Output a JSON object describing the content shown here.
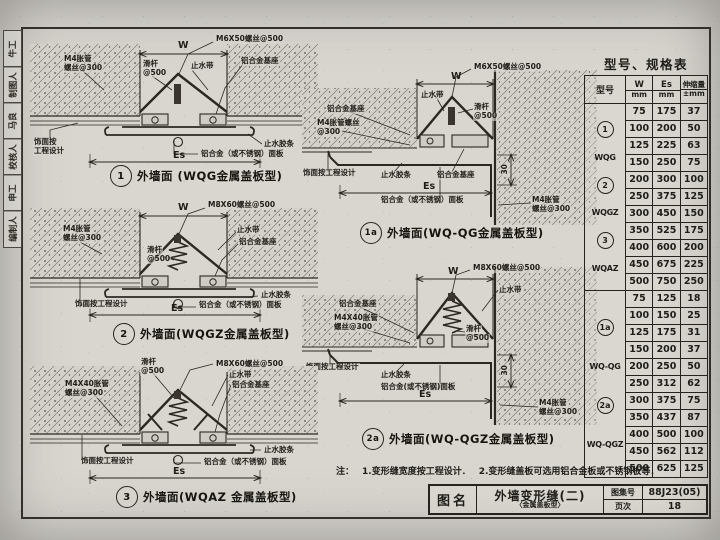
{
  "margin": {
    "cells": [
      "牛工",
      "制图人",
      "马良",
      "校核人",
      "申工",
      "编制人"
    ]
  },
  "table": {
    "title": "型号、规格表",
    "col_model": "型号",
    "col_w": "W",
    "col_es": "Es",
    "col_ext": "伸缩量",
    "unit_mm": "mm",
    "unit_pm": "±mm",
    "group1": {
      "types": [
        {
          "num": "1",
          "name": "WQG"
        },
        {
          "num": "2",
          "name": "WQGZ"
        },
        {
          "num": "3",
          "name": "WQAZ"
        }
      ],
      "rows": [
        [
          "75",
          "175",
          "37"
        ],
        [
          "100",
          "200",
          "50"
        ],
        [
          "125",
          "225",
          "63"
        ],
        [
          "150",
          "250",
          "75"
        ],
        [
          "200",
          "300",
          "100"
        ],
        [
          "250",
          "375",
          "125"
        ],
        [
          "300",
          "450",
          "150"
        ],
        [
          "350",
          "525",
          "175"
        ],
        [
          "400",
          "600",
          "200"
        ],
        [
          "450",
          "675",
          "225"
        ],
        [
          "500",
          "750",
          "250"
        ]
      ]
    },
    "group2": {
      "types": [
        {
          "num": "1a",
          "name": "WQ-QG"
        },
        {
          "num": "2a",
          "name": "WQ-QGZ"
        }
      ],
      "rows": [
        [
          "75",
          "125",
          "18"
        ],
        [
          "100",
          "150",
          "25"
        ],
        [
          "125",
          "175",
          "31"
        ],
        [
          "150",
          "200",
          "37"
        ],
        [
          "200",
          "250",
          "50"
        ],
        [
          "250",
          "312",
          "62"
        ],
        [
          "300",
          "375",
          "75"
        ],
        [
          "350",
          "437",
          "87"
        ],
        [
          "400",
          "500",
          "100"
        ],
        [
          "450",
          "562",
          "112"
        ],
        [
          "500",
          "625",
          "125"
        ]
      ]
    }
  },
  "note": {
    "prefix": "注：",
    "item1": "1.变形缝宽度按工程设计．",
    "item2": "2.变形缝盖板可选用铝合金板或不锈钢板等．"
  },
  "titleblock": {
    "name_label": "图名",
    "title": "外墙变形缝(二)",
    "subtitle": "〈金属盖板型〉",
    "atlas_label": "图集号",
    "atlas_no": "88J23(05)",
    "page_label": "页次",
    "page_no": "18"
  },
  "drawings": {
    "d1": {
      "num": "1",
      "caption": "外墙面 (WQG金属盖板型)",
      "labels": {
        "m4_1": "M4胀管",
        "m4_2": "螺丝@300",
        "rod_1": "滑杆",
        "rod_2": "@500",
        "w": "W",
        "screw": "M6X50螺丝@500",
        "stop": "止水带",
        "base": "铝合金基座",
        "finish_1": "饰面按",
        "finish_2": "工程设计",
        "es": "Es",
        "seal": "止水胶条",
        "plate": "铝合金（或不锈钢）面板"
      }
    },
    "d1a": {
      "num": "1a",
      "caption": "外墙面(WQ-QG金属盖板型)",
      "labels": {
        "screw": "M6X50螺丝@500",
        "w": "W",
        "stop": "止水带",
        "rod_1": "滑杆",
        "rod_2": "@500",
        "base_l": "铝合金基座",
        "m4a_1": "M4胀管螺丝",
        "m4a_2": "@300",
        "finish": "饰面按工程设计",
        "seal": "止水胶条",
        "base_c": "铝合金基座",
        "es": "Es",
        "plate": "铝合金（或不锈钢）面板",
        "dim30": "30",
        "m4b_1": "M4胀管",
        "m4b_2": "螺丝@300"
      }
    },
    "d2": {
      "num": "2",
      "caption": "外墙面(WQGZ金属盖板型)",
      "labels": {
        "m4_1": "M4胀管",
        "m4_2": "螺丝@300",
        "w": "W",
        "screw": "M8X60螺丝@500",
        "stop": "止水带",
        "base": "铝合金基座",
        "rod_1": "滑杆",
        "rod_2": "@500",
        "finish": "饰面按工程设计",
        "es": "Es",
        "seal": "止水胶条",
        "plate": "铝合金（或不锈钢）面板"
      }
    },
    "d2a": {
      "num": "2a",
      "caption": "外墙面(WQ-QGZ金属盖板型)",
      "labels": {
        "screw": "M8X60螺丝@500",
        "w": "W",
        "stop": "止水带",
        "base": "铝合金基座",
        "m4a_1": "M4X40胀管",
        "m4a_2": "螺丝@300",
        "rod_1": "滑杆",
        "rod_2": "@500",
        "finish": "饰面按工程设计",
        "seal": "止水胶条",
        "plate": "铝合金(或不锈钢)面板",
        "es": "Es",
        "dim30": "30",
        "m4b_1": "M4胀管",
        "m4b_2": "螺丝@300"
      }
    },
    "d3": {
      "num": "3",
      "caption": "外墙面(WQAZ 金属盖板型)",
      "labels": {
        "rod_1": "滑杆",
        "rod_2": "@500",
        "screw": "M8X60螺丝@500",
        "stop": "止水带",
        "base": "铝合金基座",
        "m4_1": "M4X40胀管",
        "m4_2": "螺丝@300",
        "finish": "饰面按工程设计",
        "seal": "止水胶条",
        "plate": "铝合金（或不锈钢）面板",
        "es": "Es"
      }
    }
  }
}
